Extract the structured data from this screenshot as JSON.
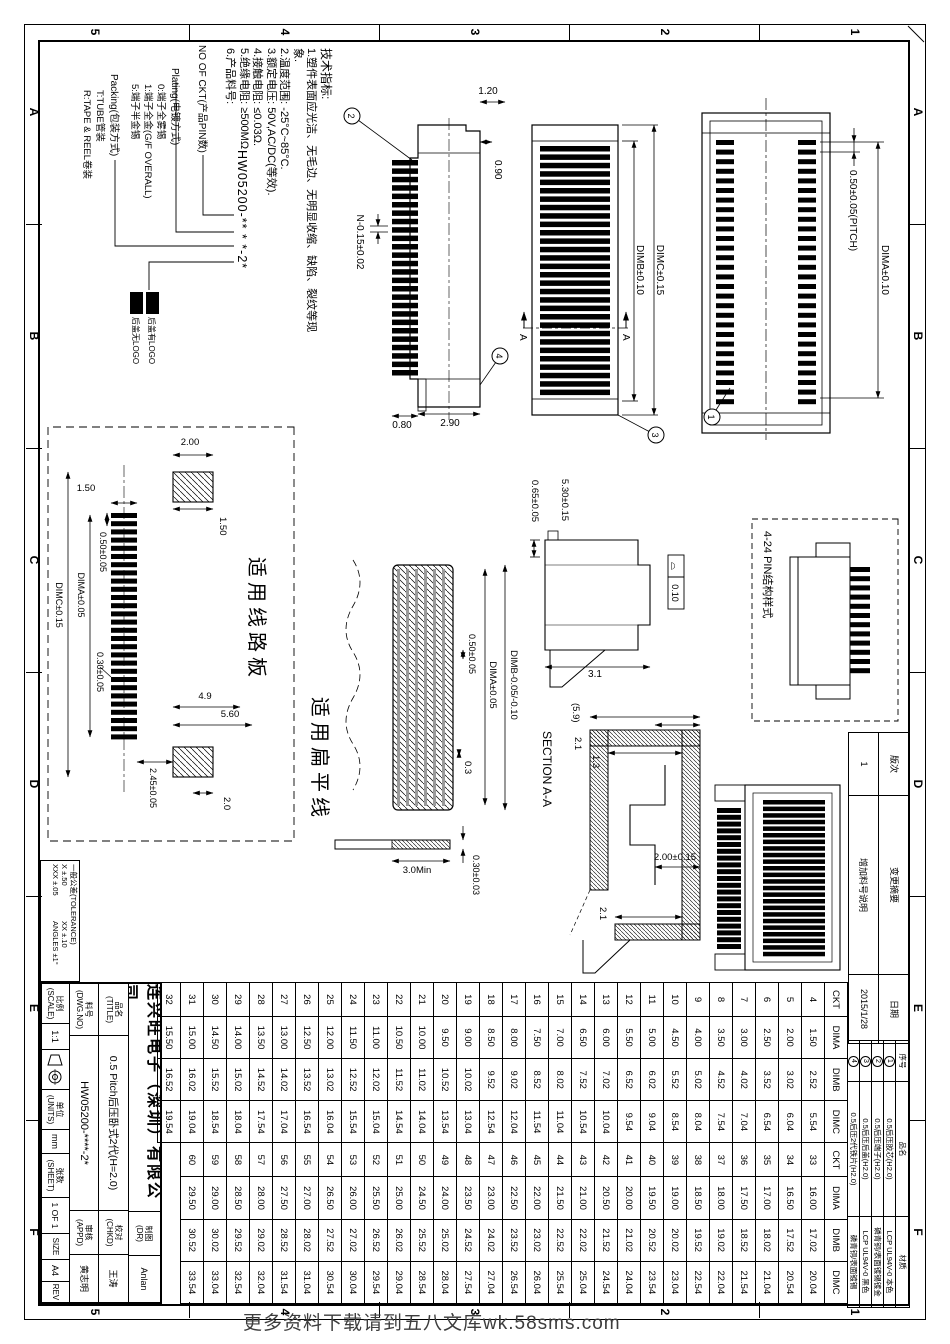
{
  "frame": {
    "cols": [
      "A",
      "B",
      "C",
      "D",
      "E",
      "F"
    ],
    "rows": [
      "1",
      "2",
      "3",
      "4",
      "5"
    ]
  },
  "notes": {
    "title": "技术指标:",
    "items": [
      "1.塑件表面应光洁、无毛边、无明显收缩、缺陷、裂纹等现象.",
      "2.温度范围: -25°C~85°C.",
      "3.额定电压: 50V,AC/DC(等效).",
      "4.接触电阻: ≤0.03Ω.",
      "5.绝缘电阻: ≥500MΩ",
      "6.产品料号:"
    ]
  },
  "part_number": {
    "code": "HW05200-** * *-2*",
    "ckt_label": "NO OF CKT(产品PIN数)",
    "plating_label": "Plating(电镀方式)",
    "plating_options": [
      "0:端子全雾锡",
      "1:端子全金(G/F OVERALL)",
      "5:端子半金锡"
    ],
    "packing_label": "Packing(包装方式)",
    "packing_options": [
      "T:TUBE管装",
      "R:TAPE & REEL卷装"
    ],
    "cover_options": [
      {
        "code": "20",
        "desc": "后盖有LOGO"
      },
      {
        "code": "2W",
        "desc": "后盖无LOGO"
      }
    ]
  },
  "dims": {
    "v1_cap": "1.20",
    "v1_step": "0.90",
    "v1_tooth": "N-0.15±0.02",
    "v1_root": "0.80",
    "v1_end": "2.90",
    "v2_dimc": "DIMC±0.15",
    "v2_dimb": "DIMB±0.10",
    "sec_mark": "A",
    "v3_dima": "DIMA±0.10",
    "v3_pitch": "0.50±0.05(PITCH)",
    "sv_h1": "0.65±0.05",
    "sv_h2": "5.30±0.15",
    "sv_w": "3.1",
    "sv_flat_sym": "⌓",
    "sv_flat": "0.10",
    "sec_a": "2.1",
    "sec_b": "(5.9)",
    "sec_c": "1.3",
    "sec_d": "2.1",
    "sec_e": "2.00±0.15",
    "sec_label": "SECTION A-A",
    "pin_box_label": "4-24 PIN结构样式",
    "pcb_label": "适用线路板",
    "ffc_label": "适用扁平线",
    "pcb_pad_w": "2.00",
    "pcb_pad_h1": "1.50",
    "pcb_pad_h2": "1.50",
    "pcb_pitch": "0.50±0.05",
    "pcb_dima": "DIMA±0.05",
    "pcb_w": "0.30±0.05",
    "pcb_dimc": "DIMC±0.15",
    "pcb_gap": "2.45±0.05",
    "pcb_g2": "2.0",
    "pcb_49": "4.9",
    "pcb_56": "5.60",
    "ffc_dimb": "DIMB-0.05/-0.10",
    "ffc_dima": "DIMA±0.05",
    "ffc_pitch": "0.50±0.05",
    "ffc_w": "0.3",
    "ffc_len": "3.0Min",
    "ffc_t": "0.30±0.03"
  },
  "balloons": {
    "b1": "1",
    "b2": "2",
    "b3": "3",
    "b4": "4"
  },
  "revision": {
    "banci_label": "版次",
    "banci": "1",
    "summary_label": "变更摘要",
    "summary": "增加料号说明",
    "date_label": "日期",
    "date": "2015/1/28"
  },
  "parts": {
    "headers": [
      "序号",
      "品名",
      "材质"
    ],
    "rows": [
      {
        "no": "1",
        "name": "0.5后压胶芯(H2.0)",
        "material": "LCP UL94V-0 本色"
      },
      {
        "no": "2",
        "name": "0.5后压端子(H2.0)",
        "material": "磷青铜/表面镀锡镀金"
      },
      {
        "no": "3",
        "name": "0.5后压后盖(H2.0)",
        "material": "LCP UL94V-0 黑色"
      },
      {
        "no": "4",
        "name": "0.5后压2代铁片(H2.0)",
        "material": "磷青铜/表面镀锡"
      }
    ]
  },
  "spec_table": {
    "headers": [
      "CKT",
      "DIMA",
      "DIMB",
      "DIMC",
      "CKT",
      "DIMA",
      "DIMB",
      "DIMC"
    ],
    "rows": [
      [
        "4",
        "1.50",
        "2.52",
        "5.54",
        "33",
        "16.00",
        "17.02",
        "20.04"
      ],
      [
        "5",
        "2.00",
        "3.02",
        "6.04",
        "34",
        "16.50",
        "17.52",
        "20.54"
      ],
      [
        "6",
        "2.50",
        "3.52",
        "6.54",
        "35",
        "17.00",
        "18.02",
        "21.04"
      ],
      [
        "7",
        "3.00",
        "4.02",
        "7.04",
        "36",
        "17.50",
        "18.52",
        "21.54"
      ],
      [
        "8",
        "3.50",
        "4.52",
        "7.54",
        "37",
        "18.00",
        "19.02",
        "22.04"
      ],
      [
        "9",
        "4.00",
        "5.02",
        "8.04",
        "38",
        "18.50",
        "19.52",
        "22.54"
      ],
      [
        "10",
        "4.50",
        "5.52",
        "8.54",
        "39",
        "19.00",
        "20.02",
        "23.04"
      ],
      [
        "11",
        "5.00",
        "6.02",
        "9.04",
        "40",
        "19.50",
        "20.52",
        "23.54"
      ],
      [
        "12",
        "5.50",
        "6.52",
        "9.54",
        "41",
        "20.00",
        "21.02",
        "24.04"
      ],
      [
        "13",
        "6.00",
        "7.02",
        "10.04",
        "42",
        "20.50",
        "21.52",
        "24.54"
      ],
      [
        "14",
        "6.50",
        "7.52",
        "10.54",
        "43",
        "21.00",
        "22.02",
        "25.04"
      ],
      [
        "15",
        "7.00",
        "8.02",
        "11.04",
        "44",
        "21.50",
        "22.52",
        "25.54"
      ],
      [
        "16",
        "7.50",
        "8.52",
        "11.54",
        "45",
        "22.00",
        "23.02",
        "26.04"
      ],
      [
        "17",
        "8.00",
        "9.02",
        "12.04",
        "46",
        "22.50",
        "23.52",
        "26.54"
      ],
      [
        "18",
        "8.50",
        "9.52",
        "12.54",
        "47",
        "23.00",
        "24.02",
        "27.04"
      ],
      [
        "19",
        "9.00",
        "10.02",
        "13.04",
        "48",
        "23.50",
        "24.52",
        "27.54"
      ],
      [
        "20",
        "9.50",
        "10.52",
        "13.54",
        "49",
        "24.00",
        "25.02",
        "28.04"
      ],
      [
        "21",
        "10.00",
        "11.02",
        "14.04",
        "50",
        "24.50",
        "25.52",
        "28.54"
      ],
      [
        "22",
        "10.50",
        "11.52",
        "14.54",
        "51",
        "25.00",
        "26.02",
        "29.04"
      ],
      [
        "23",
        "11.00",
        "12.02",
        "15.04",
        "52",
        "25.50",
        "26.52",
        "29.54"
      ],
      [
        "24",
        "11.50",
        "12.52",
        "15.54",
        "53",
        "26.00",
        "27.02",
        "30.04"
      ],
      [
        "25",
        "12.00",
        "13.02",
        "16.04",
        "54",
        "26.50",
        "27.52",
        "30.54"
      ],
      [
        "26",
        "12.50",
        "13.52",
        "16.54",
        "55",
        "27.00",
        "28.02",
        "31.04"
      ],
      [
        "27",
        "13.00",
        "14.02",
        "17.04",
        "56",
        "27.50",
        "28.52",
        "31.54"
      ],
      [
        "28",
        "13.50",
        "14.52",
        "17.54",
        "57",
        "28.00",
        "29.02",
        "32.04"
      ],
      [
        "29",
        "14.00",
        "15.02",
        "18.04",
        "58",
        "28.50",
        "29.52",
        "32.54"
      ],
      [
        "30",
        "14.50",
        "15.52",
        "18.54",
        "59",
        "29.00",
        "30.02",
        "33.04"
      ],
      [
        "31",
        "15.00",
        "16.02",
        "19.04",
        "60",
        "29.50",
        "30.52",
        "33.54"
      ],
      [
        "32",
        "15.50",
        "16.52",
        "19.54",
        "",
        "",
        "",
        ""
      ]
    ]
  },
  "titleblock": {
    "company": "连兴旺电子（深圳）有限公司",
    "title_label": "品名",
    "title_label_en": "(TITLE)",
    "title": "0.5 Pitch后压卧式2代(H=2.0)",
    "dwgno_label": "料号",
    "dwgno_label_en": "(DWG.NO)",
    "dwgno": "HW05200-****-2*",
    "dr_label": "制图",
    "dr_label_en": "(DR)",
    "dr": "Anlan",
    "chkd_label": "校对",
    "chkd_label_en": "(CHKD)",
    "chkd": "王涛",
    "appd_label": "审核",
    "appd_label_en": "(APPD)",
    "appd": "黄志明",
    "scale_label": "比例",
    "scale_label_en": "(SCALE)",
    "scale": "1:1",
    "units_label": "单位",
    "units_label_en": "(UNITS)",
    "units": "mm",
    "sheet_label": "张数",
    "sheet_label_en": "(SHEET)",
    "sheet": "1 OF 1",
    "size_label": "SIZE",
    "size": "A4",
    "rev_label": "REV",
    "rev": ""
  },
  "tolerance": {
    "title": "一般公差(TOLERANCE)",
    "lines": [
      "X ±.50",
      "XX ±.10",
      "XXX ±.05",
      "ANGLES ±1°"
    ]
  },
  "watermark": "更多资料下载请到五八文库wk.58sms.com"
}
